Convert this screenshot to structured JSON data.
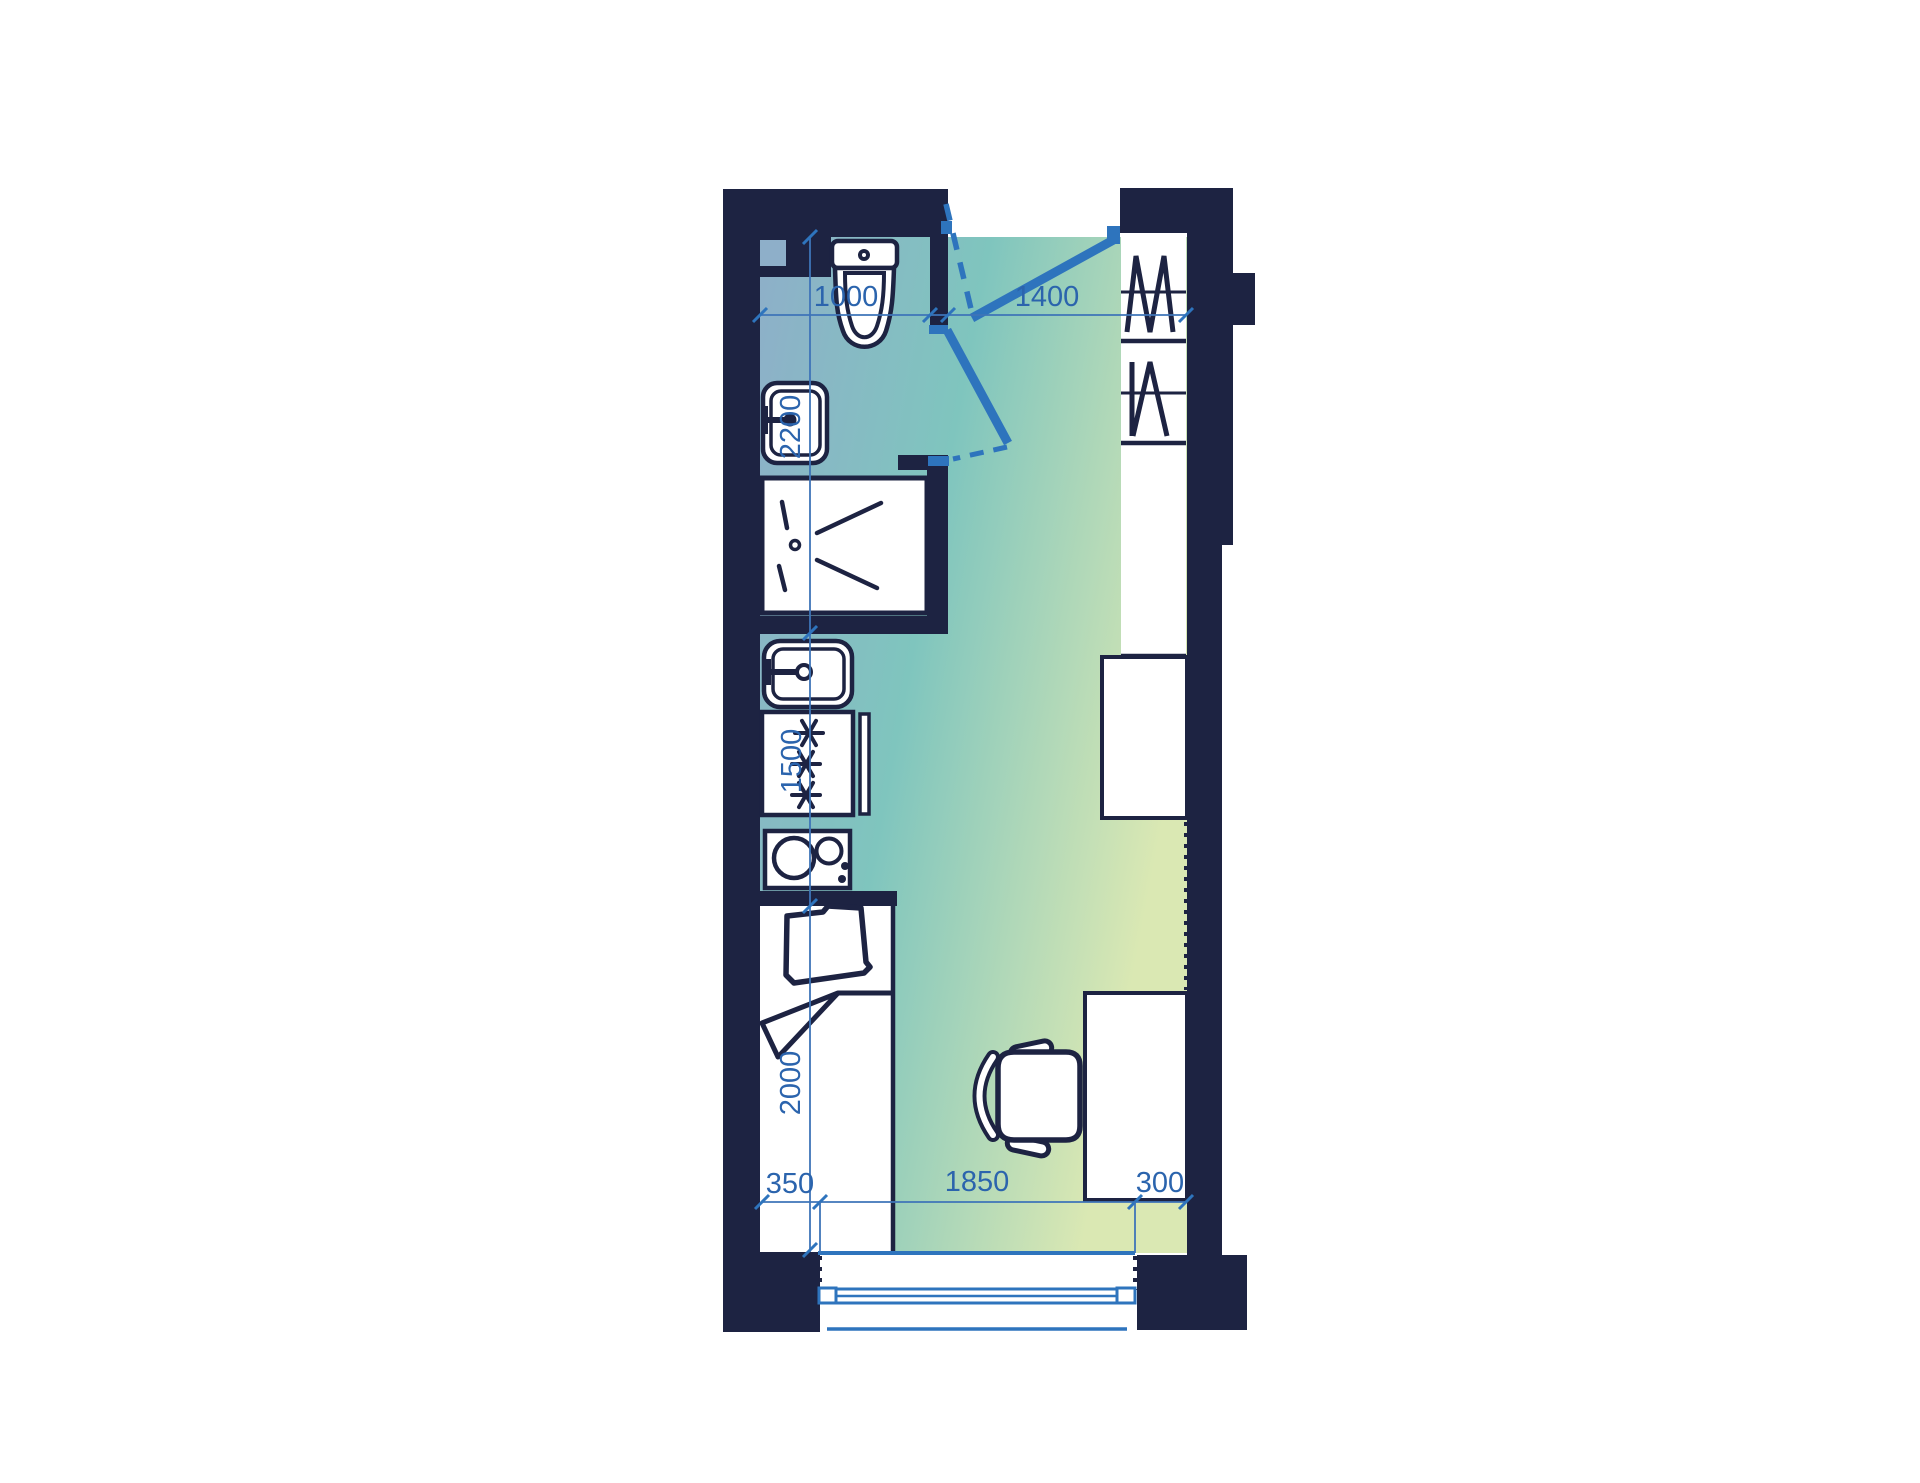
{
  "title": "Studio apartment floor plan",
  "colors": {
    "wall": "#1D2342",
    "door_accent": "#2E74BD",
    "dimension_text": "#2B64AD",
    "dimension_line": "#3E74B8",
    "floor_blue": "#8EAFC9",
    "floor_teal": "#7FC5BE",
    "floor_green": "#DAE8B3",
    "fixture_fill": "#FFFFFF",
    "background": "#FFFFFF"
  },
  "dimensions_mm": {
    "bathroom_width": "1000",
    "entry_zone_width": "1400",
    "bathroom_length": "2200",
    "kitchen_run_length": "1500",
    "bed_length": "2000",
    "bed_side_offset": "350",
    "window_span": "1850",
    "desk_side_offset": "300"
  },
  "fixtures": [
    "toilet",
    "washbasin",
    "shower",
    "kitchen-sink",
    "refrigerator",
    "cooktop",
    "bed",
    "pillow",
    "blanket",
    "office-chair",
    "desk",
    "counter",
    "wardrobe",
    "window",
    "entrance-door",
    "bathroom-door"
  ]
}
